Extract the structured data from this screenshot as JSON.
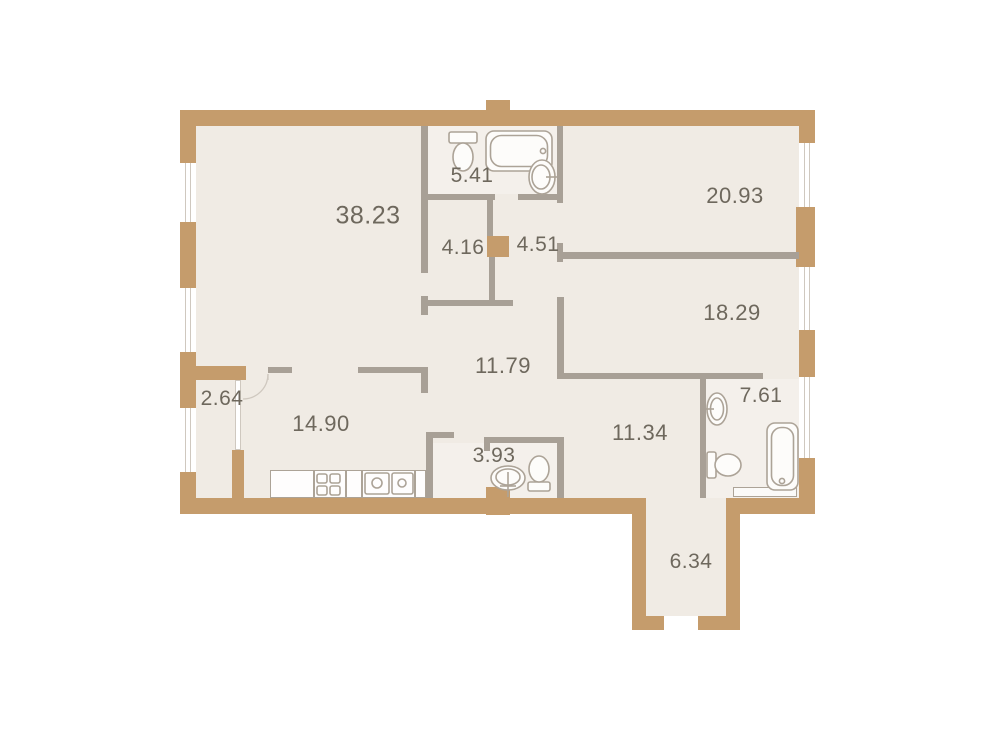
{
  "plan": {
    "kind": "apartment-floor-plan",
    "rooms": [
      {
        "name": "living-room",
        "label": "38.23",
        "cx": 368,
        "cy": 216,
        "fs": 25
      },
      {
        "name": "bathroom-top",
        "label": "5.41",
        "cx": 472,
        "cy": 176,
        "fs": 21
      },
      {
        "name": "bedroom-top-right",
        "label": "20.93",
        "cx": 735,
        "cy": 196,
        "fs": 22
      },
      {
        "name": "wardrobe",
        "label": "4.16",
        "cx": 463,
        "cy": 248,
        "fs": 21
      },
      {
        "name": "hall-upper",
        "label": "4.51",
        "cx": 538,
        "cy": 245,
        "fs": 21
      },
      {
        "name": "bedroom-right",
        "label": "18.29",
        "cx": 732,
        "cy": 313,
        "fs": 22
      },
      {
        "name": "hallway",
        "label": "11.79",
        "cx": 503,
        "cy": 366,
        "fs": 22
      },
      {
        "name": "balcony",
        "label": "2.64",
        "cx": 222,
        "cy": 399,
        "fs": 21
      },
      {
        "name": "kitchen",
        "label": "14.90",
        "cx": 321,
        "cy": 424,
        "fs": 22
      },
      {
        "name": "bathroom-bottom",
        "label": "3.93",
        "cx": 494,
        "cy": 456,
        "fs": 21
      },
      {
        "name": "room-bottom-right",
        "label": "11.34",
        "cx": 640,
        "cy": 433,
        "fs": 22
      },
      {
        "name": "bathroom-ensuite",
        "label": "7.61",
        "cx": 761,
        "cy": 396,
        "fs": 21
      },
      {
        "name": "entrance-hall",
        "label": "6.34",
        "cx": 691,
        "cy": 562,
        "fs": 21
      }
    ],
    "colors": {
      "outer_wall": "#c59c6c",
      "inner_wall": "#a8a096",
      "floor": "#f0ebe4",
      "floor_wet": "#f4f0eb",
      "window_line": "#cfc8bf",
      "fixture_line": "#aca397",
      "label_text": "#6e685d",
      "background": "#ffffff"
    },
    "fixtures": [
      "toilet-icon-bathroom-top",
      "bathtub-icon-bathroom-top",
      "sink-icon-bathroom-top",
      "sink-icon-bathroom-bottom",
      "toilet-icon-bathroom-bottom",
      "sink-icon-bathroom-ensuite",
      "toilet-icon-bathroom-ensuite",
      "bathtub-icon-bathroom-ensuite",
      "kitchen-counter",
      "stove-icon",
      "kitchen-sink-icon",
      "balcony-door-swing"
    ]
  }
}
